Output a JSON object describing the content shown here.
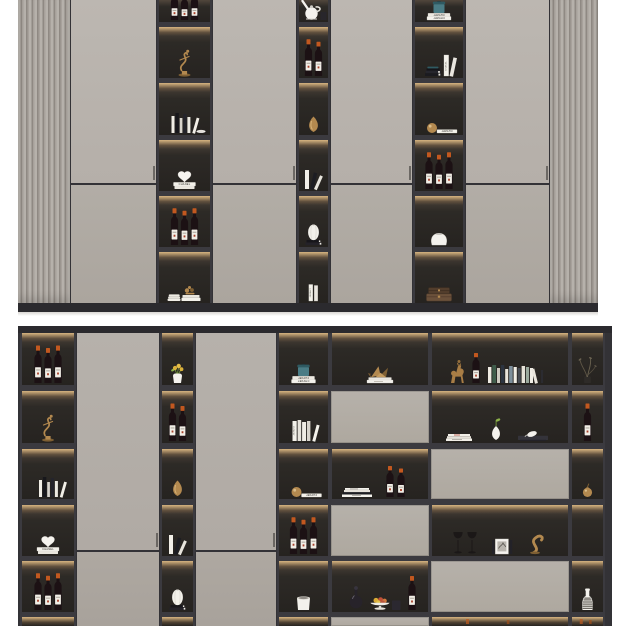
{
  "scene": "wall display cabinet renders, two stacked product views",
  "brand_text": "CHANEL",
  "colors": {
    "background": "#ffffff",
    "frame": "#333236",
    "frame_dark": "#2b2a2e",
    "shelf_cell_top": "#51463c",
    "shelf_cell_bg": "#262320",
    "glow": "#eec78c",
    "door": "#b8b3ad",
    "door_lower": "#aba59e",
    "panel": "#b2ada6",
    "flute_light": "#b6b1ab",
    "flute_dark": "#8f8983",
    "base_shadow": "#d8d6d2",
    "gold": "#b3894f",
    "gold_dark": "#7e5f33",
    "bottle": "#1c1114",
    "cap_red": "#c2581f",
    "cap_dark": "#241518",
    "label_paper": "#f1eee6",
    "paper_edge": "#c9c5bd",
    "book_dark": "#1e1e22",
    "book_gray": "#d6d2ca",
    "teal": "#4a7c85",
    "teal_dark": "#2f5a62",
    "box_brown": "#6b513b",
    "box_brown_dark": "#523d2c",
    "leaf_green": "#7fa83f",
    "flower_yellow": "#d9b13a",
    "fruit_red": "#c05038",
    "fruit_orange": "#d07a3e",
    "white_item": "#f4f2ed"
  },
  "top_cabinet": {
    "name": "upper wall cabinet",
    "fluted_side_panels": 2,
    "door_count": 4,
    "columns": [
      {
        "cells": [
          {
            "type": "bottles",
            "name": "wine-bottles",
            "n": 3,
            "cap": "dark",
            "cut": true
          },
          {
            "type": "gold-figurine",
            "name": "gold-dancer-figurine"
          },
          {
            "type": "books-stack",
            "name": "books-and-dish",
            "dish": true
          },
          {
            "type": "heart-vase",
            "name": "heart-vase-on-chanel-book",
            "label": "CHANEL"
          },
          {
            "type": "bottles",
            "name": "wine-bottles",
            "n": 3,
            "cap": "red"
          },
          {
            "type": "gold-ornament-books",
            "name": "gold-ornament-on-books"
          }
        ]
      },
      {
        "cells": [
          {
            "type": "pitcher",
            "name": "white-pitcher",
            "cut": true
          },
          {
            "type": "bottles",
            "name": "wine-bottles",
            "n": 2,
            "cap": "red"
          },
          {
            "type": "gold-vase",
            "name": "gold-vase"
          },
          {
            "type": "books-lean",
            "name": "leaning-books"
          },
          {
            "type": "ribbed-vase-books",
            "name": "ribbed-vase-on-books"
          },
          {
            "type": "chanel-spines",
            "name": "chanel-book-spines",
            "label": "CHANEL",
            "mirrored": true
          }
        ]
      },
      {
        "cells": [
          {
            "type": "chanel-flat-canister",
            "name": "chanel-books-with-canister",
            "label": "CHANEL",
            "mirrored": true,
            "cut": true
          },
          {
            "type": "books-chanel-mix",
            "name": "books-with-chanel-spine",
            "label": "CHANEL"
          },
          {
            "type": "gold-ball-chanel",
            "name": "gold-sphere-on-chanel-book",
            "label": "CHANEL",
            "mirrored": true
          },
          {
            "type": "bottles",
            "name": "wine-bottles",
            "n": 3,
            "cap": "red"
          },
          {
            "type": "round-pot",
            "name": "white-vase"
          },
          {
            "type": "brown-boxes",
            "name": "vintage-boxes"
          }
        ]
      }
    ]
  },
  "bottom_cabinet": {
    "name": "lower wall cabinet",
    "door_count": 2,
    "columns": [
      {
        "cells": [
          {
            "type": "bottles",
            "name": "wine-bottles",
            "n": 3,
            "cap": "red"
          },
          {
            "type": "gold-figurine",
            "name": "gold-dancer-figurine"
          },
          {
            "type": "books-stack",
            "name": "standing-books"
          },
          {
            "type": "heart-vase",
            "name": "heart-vase-on-chanel-book",
            "label": "CHANEL"
          },
          {
            "type": "bottles",
            "name": "wine-bottles",
            "n": 3,
            "cap": "red"
          },
          {
            "type": "empty",
            "name": "shadowed-shelf"
          }
        ]
      },
      {
        "cells": [
          {
            "type": "flower-vase",
            "name": "vase-with-flowers"
          },
          {
            "type": "bottles",
            "name": "wine-bottles",
            "n": 2,
            "cap": "red"
          },
          {
            "type": "gold-vase",
            "name": "gold-vase"
          },
          {
            "type": "books-lean",
            "name": "leaning-books"
          },
          {
            "type": "ribbed-vase-books",
            "name": "ribbed-vase-on-books"
          },
          {
            "type": "empty",
            "name": "shadowed-shelf"
          }
        ]
      },
      {
        "cells": [
          {
            "type": "chanel-flat-canister",
            "name": "chanel-books-with-canister",
            "label": "CHANEL",
            "mirrored": true
          },
          {
            "type": "books-vertical-white",
            "name": "white-book-spines",
            "label": "CHANEL",
            "mirrored": true
          },
          {
            "type": "gold-ball-chanel",
            "name": "gold-apple-on-chanel-book",
            "label": "CHANEL",
            "mirrored": true
          },
          {
            "type": "bottles",
            "name": "wine-bottles",
            "n": 3,
            "cap": "red"
          },
          {
            "type": "white-planter",
            "name": "white-planter"
          },
          {
            "type": "empty",
            "name": "shadowed-shelf"
          }
        ]
      }
    ],
    "grid_columns": [
      {
        "cells": [
          {
            "type": "crane-books",
            "name": "origami-crane-on-books"
          },
          {
            "type": "panel",
            "name": "drawer-panel"
          },
          {
            "type": "books-bottles",
            "name": "magazines-and-wine"
          },
          {
            "type": "panel",
            "name": "drawer-panel"
          },
          {
            "type": "fruit-set",
            "name": "fruit-bowl-decanter-wine"
          },
          {
            "type": "panel",
            "name": "drawer-panel"
          }
        ]
      },
      {
        "cells": [
          {
            "type": "horse-books",
            "name": "horse-figurine-wine-books"
          },
          {
            "type": "books-vase-tray",
            "name": "books-vase-and-tray"
          },
          {
            "type": "panel",
            "name": "drawer-panel"
          },
          {
            "type": "glasses-art-gold",
            "name": "wine-glasses-art-book-sculpture"
          },
          {
            "type": "panel",
            "name": "drawer-panel"
          },
          {
            "type": "dark-hint",
            "name": "shadowed-shelf"
          }
        ]
      },
      {
        "cells": [
          {
            "type": "branch",
            "name": "dry-branch"
          },
          {
            "type": "bottles",
            "name": "wine-bottle",
            "n": 1,
            "cap": "red"
          },
          {
            "type": "gold-pear",
            "name": "gold-pear"
          },
          {
            "type": "empty",
            "name": "empty-shelf"
          },
          {
            "type": "striped-vase",
            "name": "striped-vase"
          },
          {
            "type": "dark-hint",
            "name": "shadowed-shelf"
          }
        ]
      }
    ]
  }
}
